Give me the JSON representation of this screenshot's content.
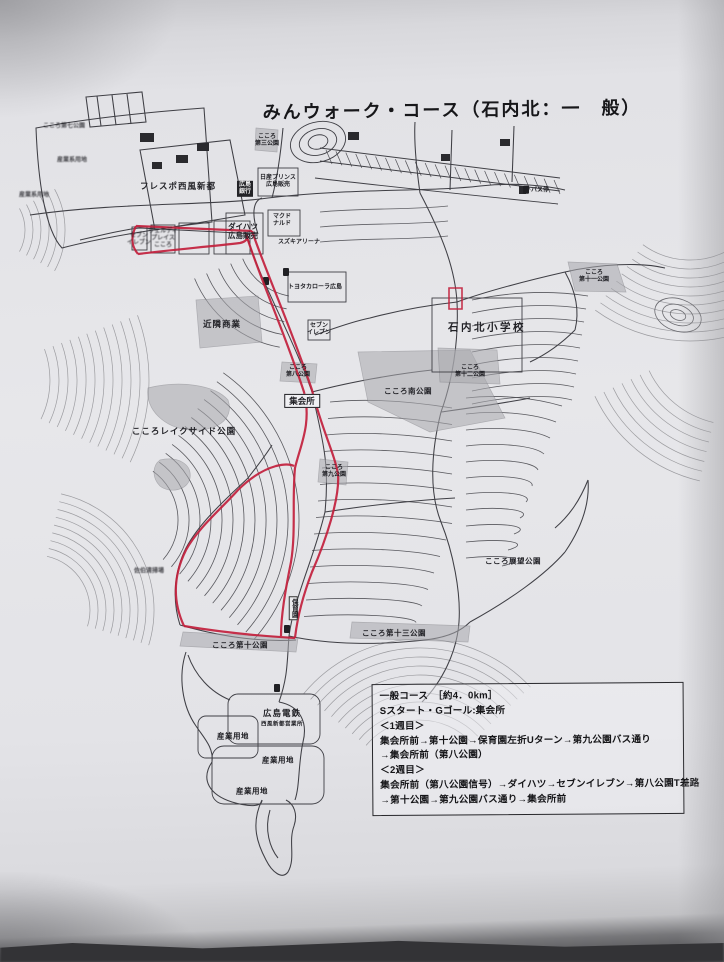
{
  "title": "みんウォーク・コース（石内北：一　般）",
  "colors": {
    "route_red": "#c2203c",
    "road_ink": "#3f3f45",
    "contour_ink": "#6b6b70",
    "park_gray": "#a9a9ae",
    "paper": "#e6e6e9"
  },
  "info_box": {
    "lines": [
      "一般コース　［約4．0km］",
      "Sスタート・Gゴール:集会所",
      "＜1週目＞",
      "集会所前→第十公園→保育園左折Uターン→第九公園バス通り",
      "→集会所前（第八公園）",
      "＜2週目＞",
      "集会所前（第八公園信号）→ダイハツ→セブンイレブン→第八公園T差路",
      "→第十公園→第九公園バス通り→集会所前"
    ]
  },
  "map": {
    "labels": [
      {
        "name": "label-kokoro-7-park",
        "text": "こころ第七公園",
        "x": 64,
        "y": 127,
        "cls": "t-micro t-blur"
      },
      {
        "name": "label-sangyokei-1",
        "text": "産業系用地",
        "x": 72,
        "y": 161,
        "cls": "t-micro t-blur"
      },
      {
        "name": "label-sangyokei-2",
        "text": "産業系用地",
        "x": 34,
        "y": 196,
        "cls": "t-micro t-blur"
      },
      {
        "name": "label-frespo-seifu-shinto",
        "text": "フレスポ西風新都",
        "x": 178,
        "y": 186,
        "cls": "t-small"
      },
      {
        "name": "label-kokoro-3-park",
        "text": "こころ\n第三公園",
        "x": 267,
        "y": 141,
        "cls": "t-micro"
      },
      {
        "name": "label-nissan-prince",
        "text": "日産プリンス\n広島販売",
        "x": 278,
        "y": 182,
        "cls": "t-micro"
      },
      {
        "name": "label-hiroshima-bank",
        "text": "広島\n銀行",
        "x": 245,
        "y": 189,
        "cls": "t-blackbox"
      },
      {
        "name": "label-mcdonalds",
        "text": "マクド\nナルド",
        "x": 282,
        "y": 221,
        "cls": "t-micro"
      },
      {
        "name": "label-suzuki-arena",
        "text": "スズキアリーナ",
        "x": 299,
        "y": 243,
        "cls": "t-micro"
      },
      {
        "name": "label-daihatsu-hiroshima",
        "text": "ダイハツ\n広島販売",
        "x": 243,
        "y": 231,
        "cls": "t-tiny2"
      },
      {
        "name": "label-seven-eleven-west",
        "text": "セブン\nイレブン",
        "x": 139,
        "y": 240,
        "cls": "t-micro t-blur"
      },
      {
        "name": "label-verde-place-kokoro",
        "text": "ヴェルディ\nプレイス\nこころ",
        "x": 163,
        "y": 239,
        "cls": "t-micro t-blur"
      },
      {
        "name": "label-toyota-corolla",
        "text": "トヨタカローラ広島",
        "x": 315,
        "y": 288,
        "cls": "t-micro"
      },
      {
        "name": "label-bus-stop",
        "text": "バス停",
        "x": 536,
        "y": 190,
        "cls": "t-micro",
        "icon": "bus-stop"
      },
      {
        "name": "label-kinrin-shogyo",
        "text": "近隣商業",
        "x": 222,
        "y": 324,
        "cls": "t-small"
      },
      {
        "name": "label-seven-eleven-mid",
        "text": "セブン\nイレブン",
        "x": 319,
        "y": 330,
        "cls": "t-micro"
      },
      {
        "name": "label-ishiuchikita-elementary",
        "text": "石内北小学校",
        "x": 487,
        "y": 328,
        "cls": "t-med"
      },
      {
        "name": "label-kokoro-11-park",
        "text": "こころ\n第十一公園",
        "x": 594,
        "y": 277,
        "cls": "t-micro"
      },
      {
        "name": "label-kokoro-12-park",
        "text": "こころ\n第十二公園",
        "x": 470,
        "y": 372,
        "cls": "t-micro"
      },
      {
        "name": "label-kokoro-8-park",
        "text": "こころ\n第八公園",
        "x": 298,
        "y": 372,
        "cls": "t-micro"
      },
      {
        "name": "label-shukaijo",
        "text": "集会所",
        "x": 302,
        "y": 401,
        "cls": "t-box"
      },
      {
        "name": "label-kokoro-minami-park",
        "text": "こころ南公園",
        "x": 408,
        "y": 391,
        "cls": "t-tiny"
      },
      {
        "name": "label-lakeside-park",
        "text": "こころレイクサイド公園",
        "x": 184,
        "y": 431,
        "cls": "t-small"
      },
      {
        "name": "label-kokoro-9-park",
        "text": "こころ\n第九公園",
        "x": 334,
        "y": 472,
        "cls": "t-micro"
      },
      {
        "name": "label-saeki-seiso",
        "text": "佐伯清掃場",
        "x": 149,
        "y": 572,
        "cls": "t-micro t-blur"
      },
      {
        "name": "label-kokoro-tenbo-park",
        "text": "こころ展望公園",
        "x": 513,
        "y": 561,
        "cls": "t-tiny"
      },
      {
        "name": "label-hoikuen",
        "text": "保育園",
        "x": 293,
        "y": 608,
        "cls": "t-vert"
      },
      {
        "name": "label-kokoro-10-park",
        "text": "こころ第十公園",
        "x": 240,
        "y": 645,
        "cls": "t-tiny"
      },
      {
        "name": "label-kokoro-13-park",
        "text": "こころ第十三公園",
        "x": 394,
        "y": 633,
        "cls": "t-tiny"
      },
      {
        "name": "label-hiroden",
        "text": "広島電鉄",
        "x": 282,
        "y": 713,
        "cls": "t-small"
      },
      {
        "name": "label-hiroden-office",
        "text": "西風新都営業所",
        "x": 282,
        "y": 725,
        "cls": "t-micro2"
      },
      {
        "name": "label-sangyo-yochi-1",
        "text": "産業用地",
        "x": 233,
        "y": 736,
        "cls": "t-tiny"
      },
      {
        "name": "label-sangyo-yochi-2",
        "text": "産業用地",
        "x": 278,
        "y": 760,
        "cls": "t-tiny"
      },
      {
        "name": "label-sangyo-yochi-3",
        "text": "産業用地",
        "x": 252,
        "y": 791,
        "cls": "t-tiny"
      }
    ]
  }
}
